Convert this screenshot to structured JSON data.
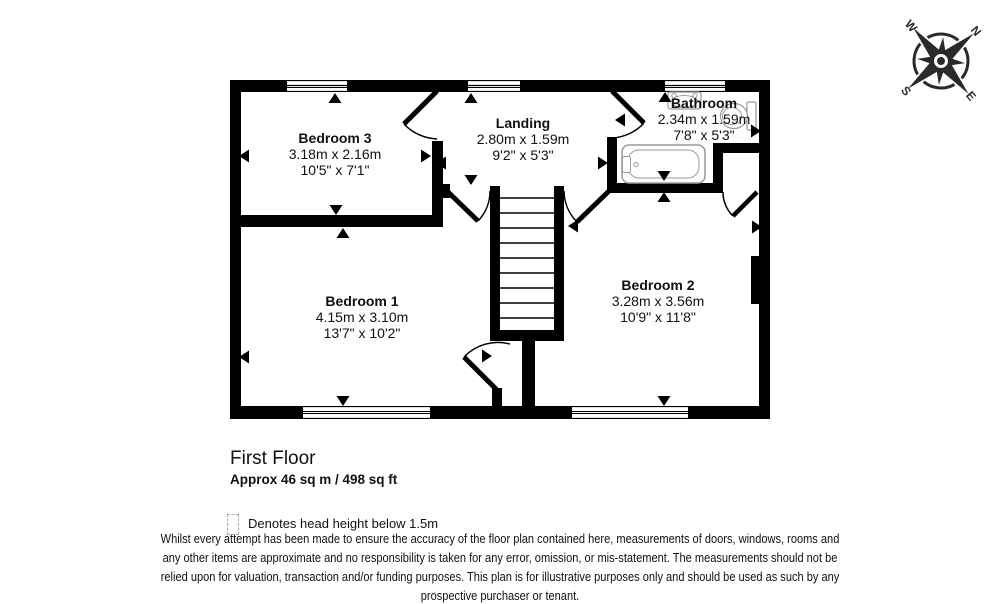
{
  "compass": {
    "north": "N",
    "east": "E",
    "south": "S",
    "west": "W"
  },
  "rooms": [
    {
      "name": "Bedroom 3",
      "metric": "3.18m x 2.16m",
      "imperial": "10'5\" x 7'1\""
    },
    {
      "name": "Landing",
      "metric": "2.80m x 1.59m",
      "imperial": "9'2\" x 5'3\""
    },
    {
      "name": "Bathroom",
      "metric": "2.34m x 1.59m",
      "imperial": "7'8\" x 5'3\""
    },
    {
      "name": "Bedroom 1",
      "metric": "4.15m x 3.10m",
      "imperial": "13'7\" x 10'2\""
    },
    {
      "name": "Bedroom 2",
      "metric": "3.28m x 3.56m",
      "imperial": "10'9\" x 11'8\""
    }
  ],
  "footer": {
    "floor_title": "First Floor",
    "floor_area": "Approx 46 sq m / 498 sq ft",
    "legend_text": "Denotes head height below 1.5m",
    "disclaimer_lines": [
      "Whilst every attempt has been made to ensure the accuracy of the floor plan contained here, measurements of doors, windows, rooms and",
      "any other items are approximate and no responsibility is taken for any error, omission, or mis-statement. The measurements should not be",
      "relied upon for valuation, transaction and/or funding purposes. This plan is for illustrative purposes only and should be used as such by any",
      "prospective purchaser or tenant."
    ]
  }
}
